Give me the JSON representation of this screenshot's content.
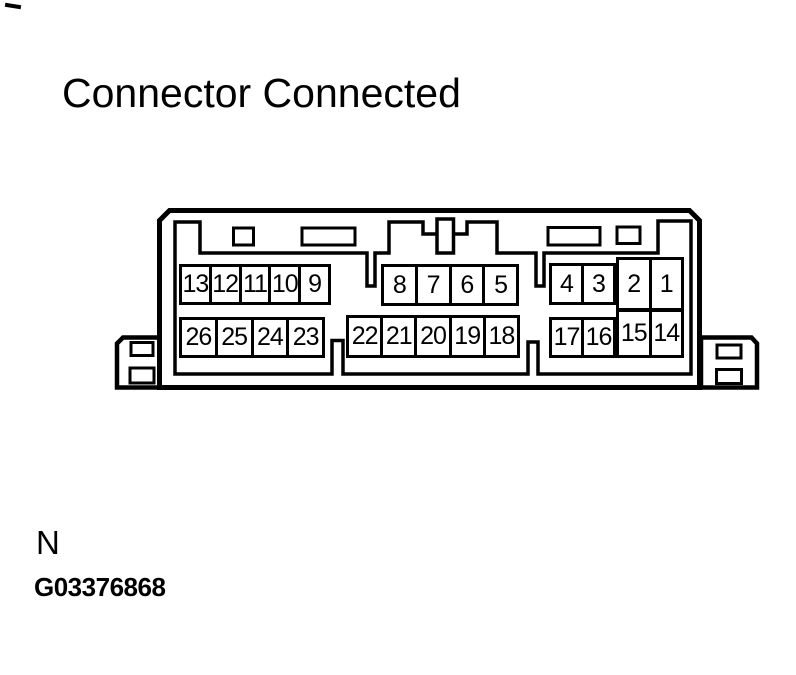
{
  "page": {
    "title": "Connector Connected",
    "note_letter": "N",
    "figure_id": "G03376868"
  },
  "colors": {
    "ink": "#000000",
    "paper": "#ffffff"
  },
  "connector": {
    "description": "26-pin connector, mating face view, connector connected",
    "pin_groups": [
      {
        "id": "top-left",
        "cells": [
          "13",
          "12",
          "11",
          "10",
          "9"
        ]
      },
      {
        "id": "top-middle",
        "cells": [
          "8",
          "7",
          "6",
          "5"
        ]
      },
      {
        "id": "top-right",
        "cells": [
          "4",
          "3"
        ]
      },
      {
        "id": "right-tall-top",
        "cells": [
          "2",
          "1"
        ]
      },
      {
        "id": "bottom-left",
        "cells": [
          "26",
          "25",
          "24",
          "23"
        ]
      },
      {
        "id": "bottom-middle",
        "cells": [
          "22",
          "21",
          "20",
          "19",
          "18"
        ]
      },
      {
        "id": "bottom-right",
        "cells": [
          "17",
          "16"
        ]
      },
      {
        "id": "right-tall-bottom",
        "cells": [
          "15",
          "14"
        ]
      }
    ]
  }
}
